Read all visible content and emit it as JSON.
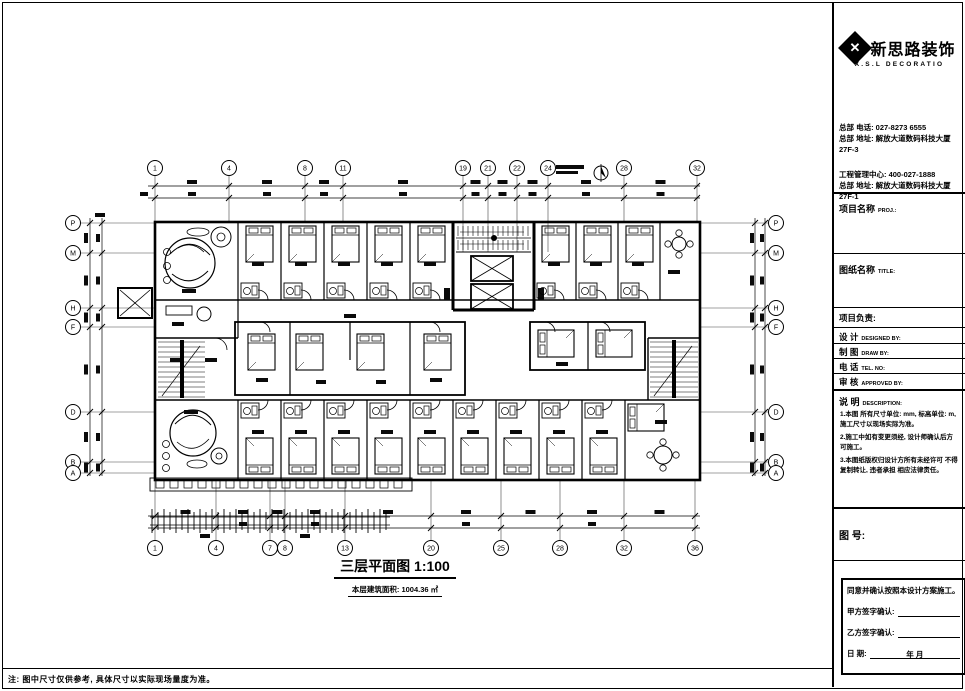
{
  "logo": {
    "mark": "✕",
    "cn": "新思路装饰",
    "en": "X.S.L DECORATIO"
  },
  "contact": {
    "line1": "总部 电话: 027-8273 6555",
    "line2": "总部 地址: 解放大道数码科技大厦27F-3",
    "line3": "工程管理中心: 400-027-1888",
    "line4": "总部 地址: 解放大道数码科技大厦27F-1"
  },
  "fields": {
    "project_label": "项目名称",
    "project_sub": "PROJ.:",
    "drawing_label": "图纸名称",
    "drawing_sub": "TITLE:",
    "leader_label": "项目负责:",
    "rows": [
      {
        "cn": "设  计",
        "en": "DESIGNED BY:"
      },
      {
        "cn": "制  图",
        "en": "DRAW BY:"
      },
      {
        "cn": "电  话",
        "en": "TEL. NO:"
      },
      {
        "cn": "审  核",
        "en": "APPROVED BY:"
      }
    ],
    "remark_label": "说  明",
    "remark_sub": "DESCRIPTION:",
    "fig_label": "图 号:"
  },
  "remarks": [
    "1.本图 所有尺寸单位: mm, 标高单位: m, 施工尺寸以现场实际为准。",
    "2.施工中如有变更须经, 设计师确认后方可施工。",
    "3.本图纸版权归设计方所有未经许可 不得 复制转让, 违者承担 相应法律责任。"
  ],
  "signoff": {
    "agree": "同意并确认按照本设计方案施工。",
    "party_a": "甲方签字确认:",
    "party_b": "乙方签字确认:",
    "date_label": "日          期:",
    "date_value": "年    月"
  },
  "plan": {
    "title": "三层平面图 1:100",
    "area": "本层建筑面积: 1004.36 ㎡",
    "note": "注: 图中尺寸仅供参考, 具体尺寸以实际现场量度为准。",
    "axes": {
      "top": [
        "1",
        "4",
        "8",
        "11",
        "19",
        "21",
        "22",
        "24",
        "28",
        "32"
      ],
      "bottom": [
        "1",
        "4",
        "7",
        "8",
        "13",
        "20",
        "25",
        "28",
        "32",
        "36"
      ],
      "left": [
        "P",
        "M",
        "H",
        "F",
        "D",
        "B",
        "A"
      ],
      "right": [
        "P",
        "M",
        "H",
        "F",
        "D",
        "B",
        "A"
      ]
    }
  }
}
